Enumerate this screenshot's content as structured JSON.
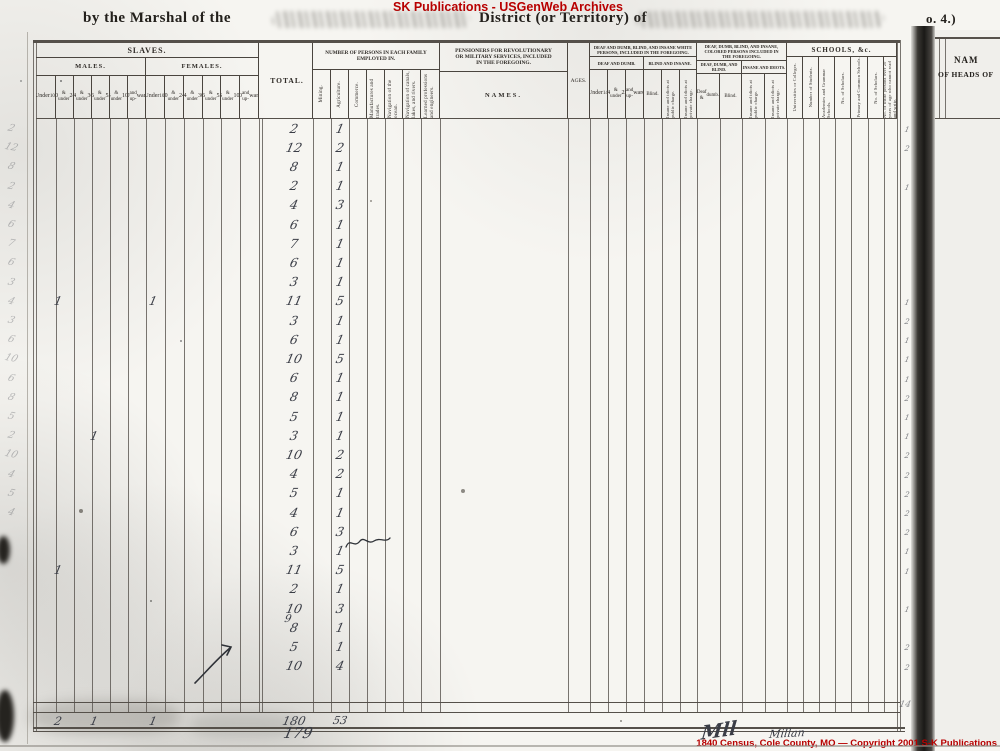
{
  "watermark_top": "SK Publications - USGenWeb Archives",
  "watermark_bottom": "1840 Census, Cole County, MO — Copyright 2001 S-K Publications",
  "header": {
    "marshal_prefix": "by the Marshal of the",
    "district_mid": "District (or Territory) of",
    "corner_no": "o. 4.)"
  },
  "page_number": "179",
  "signature": {
    "initials": "Mll",
    "name": "Millan"
  },
  "colors": {
    "red": "#b80000",
    "ink": "#3a3d46",
    "line": "#4a453f"
  },
  "table": {
    "slaves": {
      "title": "SLAVES.",
      "males": "MALES.",
      "females": "FEMALES.",
      "age_cols": [
        [
          "Under",
          "10."
        ],
        [
          "10",
          "& under",
          "24."
        ],
        [
          "24",
          "& under",
          "36."
        ],
        [
          "36",
          "& under",
          "55."
        ],
        [
          "55",
          "& under",
          "100."
        ],
        [
          "100",
          "and up-",
          "wards."
        ]
      ]
    },
    "total_label": "TOTAL.",
    "employed": {
      "title": "NUMBER OF PERSONS IN EACH FAMILY EMPLOYED IN.",
      "cols": [
        "Mining.",
        "Agriculture.",
        "Commerce.",
        "Manufactures and trades.",
        "Navigation of the ocean.",
        "Navigation of canals, lakes, and rivers.",
        "Learned professions and engineers."
      ]
    },
    "pensioners": {
      "title": "PENSIONERS FOR REVOLUTIONARY OR MILITARY SERVICES, INCLUDED IN THE FOREGOING.",
      "names_label": "NAMES.",
      "ages_label": "AGES."
    },
    "white_dd": {
      "title": "DEAF AND DUMB, BLIND, AND INSANE WHITE PERSONS, INCLUDED IN THE FOREGOING.",
      "sub1": "DEAF AND DUMB.",
      "sub2": "BLIND AND INSANE.",
      "cols": [
        [
          "Under",
          "14."
        ],
        [
          "14",
          "& under",
          "25."
        ],
        [
          "25",
          "and up-",
          "wards."
        ]
      ],
      "blind_label": "Blind.",
      "vcols": [
        "Insane and idiots at public charge.",
        "Insane and idiots at private charge."
      ]
    },
    "colored_dd": {
      "title": "DEAF, DUMB, BLIND, AND INSANE, COLORED PERSONS INCLUDED IN THE FOREGOING.",
      "sub1": "DEAF, DUMB, AND BLIND.",
      "sub2": "INSANE AND IDIOTS.",
      "col1": "Deaf & dumb.",
      "col2": "Blind.",
      "vcols": [
        "Insane and idiots at public charge.",
        "Insane and idiots at private charge."
      ]
    },
    "schools": {
      "title": "SCHOOLS, &c.",
      "cols": [
        "Universities or Colleges.",
        "Number of Students.",
        "Academies and Grammar Schools.",
        "No. of Scholars.",
        "Primary and Common Schools.",
        "No. of Scholars.",
        "No. of white persons over 20 years of age who cannot read and write."
      ]
    }
  },
  "rows": [
    {
      "total": "2",
      "agriculture": "1"
    },
    {
      "total": "12",
      "agriculture": "2"
    },
    {
      "total": "8",
      "agriculture": "1"
    },
    {
      "total": "2",
      "agriculture": "1"
    },
    {
      "total": "4",
      "agriculture": "3"
    },
    {
      "total": "6",
      "agriculture": "1"
    },
    {
      "total": "7",
      "agriculture": "1"
    },
    {
      "total": "6",
      "agriculture": "1"
    },
    {
      "total": "3",
      "agriculture": "1"
    },
    {
      "total": "11",
      "agriculture": "5",
      "males_10_24": "1",
      "females_under_10": "1"
    },
    {
      "total": "3",
      "agriculture": "1"
    },
    {
      "total": "6",
      "agriculture": "1"
    },
    {
      "total": "10",
      "agriculture": "5"
    },
    {
      "total": "6",
      "agriculture": "1"
    },
    {
      "total": "8",
      "agriculture": "1"
    },
    {
      "total": "5",
      "agriculture": "1"
    },
    {
      "total": "3",
      "agriculture": "1",
      "males_24_36": "1"
    },
    {
      "total": "10",
      "agriculture": "2"
    },
    {
      "total": "4",
      "agriculture": "2"
    },
    {
      "total": "5",
      "agriculture": "1"
    },
    {
      "total": "4",
      "agriculture": "1"
    },
    {
      "total": "6",
      "agriculture": "3"
    },
    {
      "total": "3",
      "agriculture": "1"
    },
    {
      "total": "11",
      "agriculture": "5",
      "males_10_24": "1"
    },
    {
      "total": "2",
      "agriculture": "1"
    },
    {
      "total": "10",
      "agriculture": "3",
      "inserted_total": "9"
    },
    {
      "total": "8",
      "agriculture": "1"
    },
    {
      "total": "5",
      "agriculture": "1"
    },
    {
      "total": "10",
      "agriculture": "4"
    },
    {}
  ],
  "totals": {
    "males_10_24": "2",
    "males_24_36": "1",
    "females_under_10": "1",
    "total": "180",
    "agriculture": "53"
  },
  "margin_total_mark": "14",
  "next_page": {
    "names_header_1": "NAM",
    "names_header_2": "OF HEADS OF"
  },
  "names": [
    "Solomon Ru",
    "Thomas Kemp",
    "Fermando Ca",
    "Neal Huff",
    "Dennis Con",
    "Christian B",
    "Coonrod M",
    "John Gree",
    "Moses Char",
    "Mary Mil",
    "Taylor Stee",
    "Charles M",
    "Henry He",
    "William A",
    "William T",
    "Jane Her",
    "Samuel A",
    "F. Greenwo",
    "P. Whing",
    "William G",
    "Charles Spru",
    "Samuel Spr",
    "Allen Cu",
    "W. T. Ain",
    "William C",
    "Thomas Ca",
    "Thomas Phi",
    "W. Cook",
    "J. Johnson",
    "James Bal"
  ],
  "left_margin_digits": [
    "2",
    "12",
    "8",
    "2",
    "4",
    "6",
    "7",
    "6",
    "3",
    "4",
    "3",
    "6",
    "10",
    "6",
    "8",
    "5",
    "2",
    "10",
    "4",
    "5",
    "4"
  ],
  "gutter_digits": [
    "1",
    "2",
    "",
    "1",
    "",
    "",
    "",
    "",
    "",
    "1",
    "2",
    "1",
    "1",
    "1",
    "2",
    "1",
    "1",
    "2",
    "2",
    "2",
    "2",
    "2",
    "1",
    "1",
    "",
    "1",
    "",
    "2",
    "2",
    ""
  ]
}
